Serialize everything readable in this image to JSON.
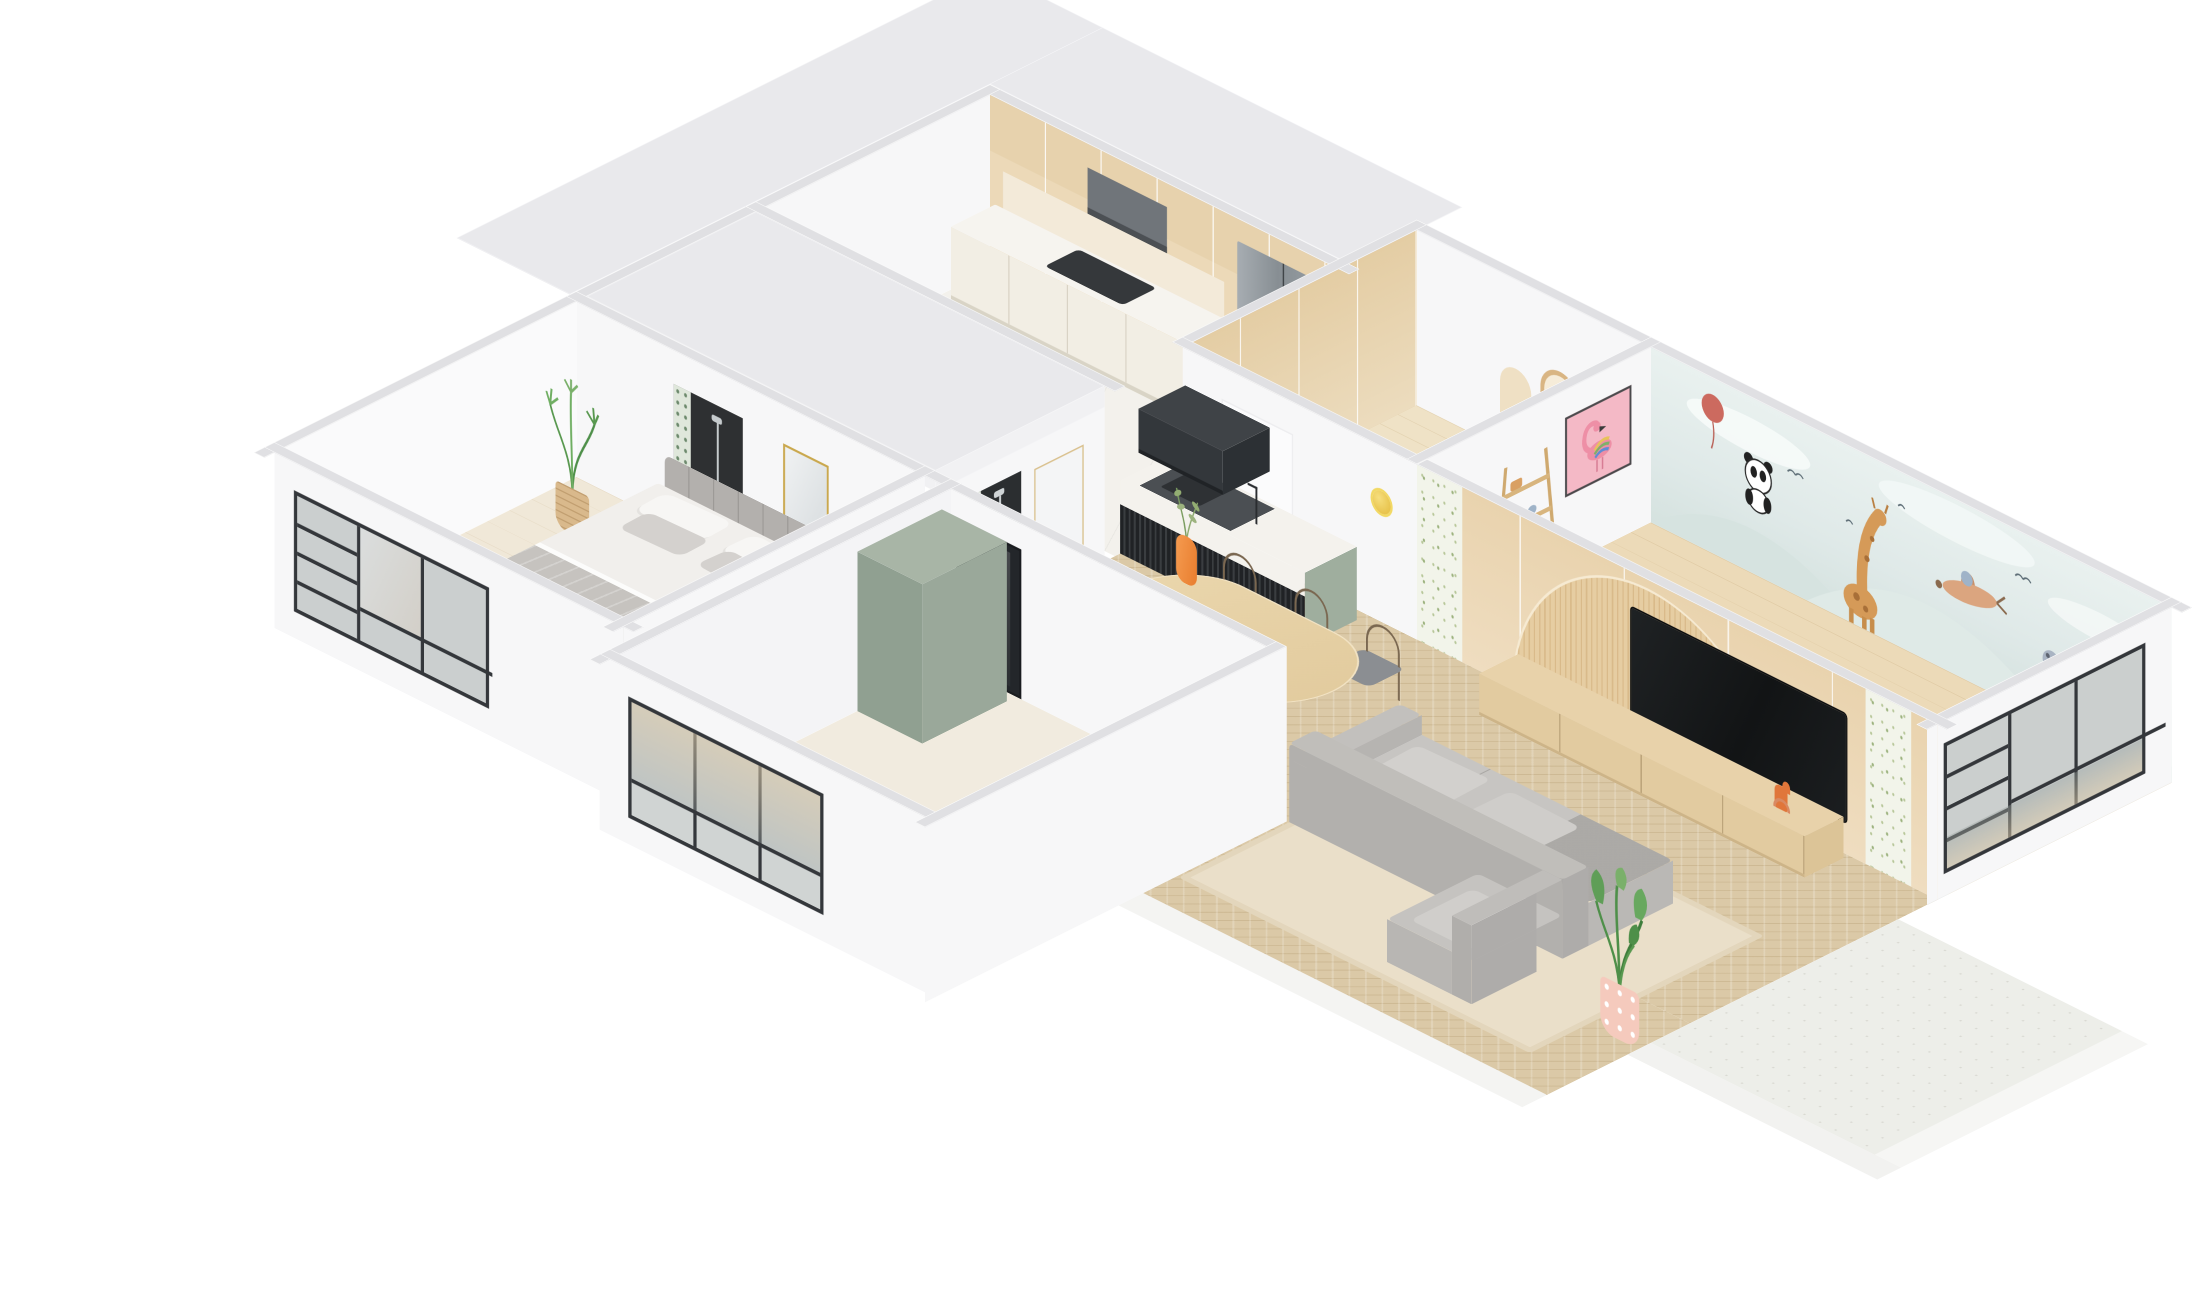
{
  "meta": {
    "title": "Isometric 3D apartment floor-plan rendering",
    "style": "soft scandinavian interior, white walls, light oak wood, cutaway axonometric view",
    "background": "plain white, no text or UI controls visible"
  },
  "palette": {
    "bg": "#ffffff",
    "wall": "#f7f7f8",
    "wall-shade": "#efeff1",
    "cap": "#e0e0e3",
    "slab": "#e9e9ec",
    "wood": "#ecd9b8",
    "wood-dark": "#dcc196",
    "herring": "#dbc9a7",
    "plank": "#ecdab8",
    "marble": "#f4f2ed",
    "frame-dark": "#34373b",
    "glass": "#9aa5a2",
    "fridge": "#9aa1a6",
    "sofa": "#c2c0bd",
    "rug": "#eadfc9",
    "sage": "#9fae9e",
    "mural": "#e4eeec",
    "art-pink": "#f4b9c6",
    "plant": "#5f9e57",
    "pot-pink": "#f5cabd",
    "accent-orange": "#ef8a3e",
    "accent-gold": "#ecc94f",
    "slat-dark": "#232528"
  },
  "rooms": {
    "kitchen": {
      "label": "Kitchen — oak tall cabinets, stainless fridge, hood, marble counter, window"
    },
    "study": {
      "label": "Entry study — oak wardrobe, arch shelf nook, brass sconce"
    },
    "kids_room": {
      "label": "Kids bedroom — watercolor animal mural, flamingo art, ladder shelf, rhino plush, panel window"
    },
    "dining": {
      "label": "Dining — oval oak table, six chairs, orange vase, marble island with black slat screen and hood"
    },
    "living": {
      "label": "Living room — grey L-sofa, beige rug, oak console, TV on fluted arch wall, strelitzia in pink dotted pot"
    },
    "master_bedroom": {
      "label": "Master bedroom — upholstered bed, grey throw, palm basket, ensuite door, gold mirror, panel windows"
    },
    "second_bedroom": {
      "label": "Second bedroom — sage wardrobe, smoked glass door, panel window"
    },
    "bathroom": {
      "label": "Bathroom under roof slab — botanical tiled shower"
    },
    "balcony": {
      "label": "Balcony — speckled stone floor with white fascia"
    }
  }
}
